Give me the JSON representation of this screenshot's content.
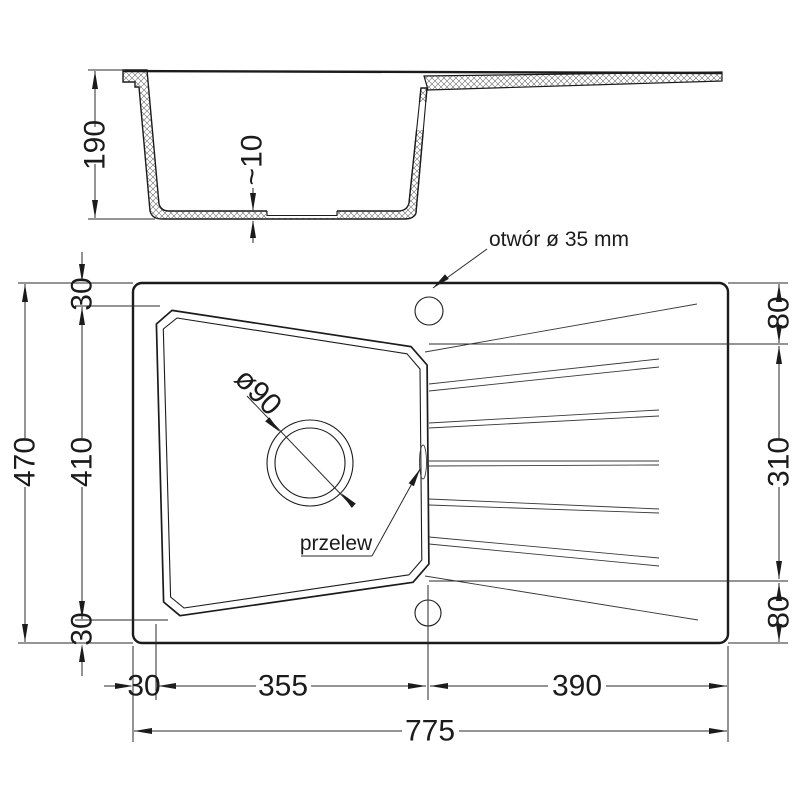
{
  "drawing": {
    "type": "kitchen sink technical drawing",
    "background": "#ffffff",
    "line_color": "#1b1b1b"
  },
  "section_view": {
    "description": "side cross-section of sink bowl with drainer",
    "dims": {
      "depth_total": "190",
      "bottom_recess": "~10"
    }
  },
  "plan_view": {
    "labels": {
      "faucet_hole": "otwór ø 35 mm",
      "overflow": "przelew",
      "drain_diameter": "ø90"
    },
    "dims": {
      "left_total": "470",
      "left_bowl": "410",
      "left_margin_top": "30",
      "left_margin_bottom": "30",
      "right_margin_top": "80",
      "right_drainer": "310",
      "right_margin_bottom": "80",
      "bottom_margin_left": "30",
      "bottom_bowl": "355",
      "bottom_drainer": "390",
      "bottom_total": "775"
    }
  }
}
